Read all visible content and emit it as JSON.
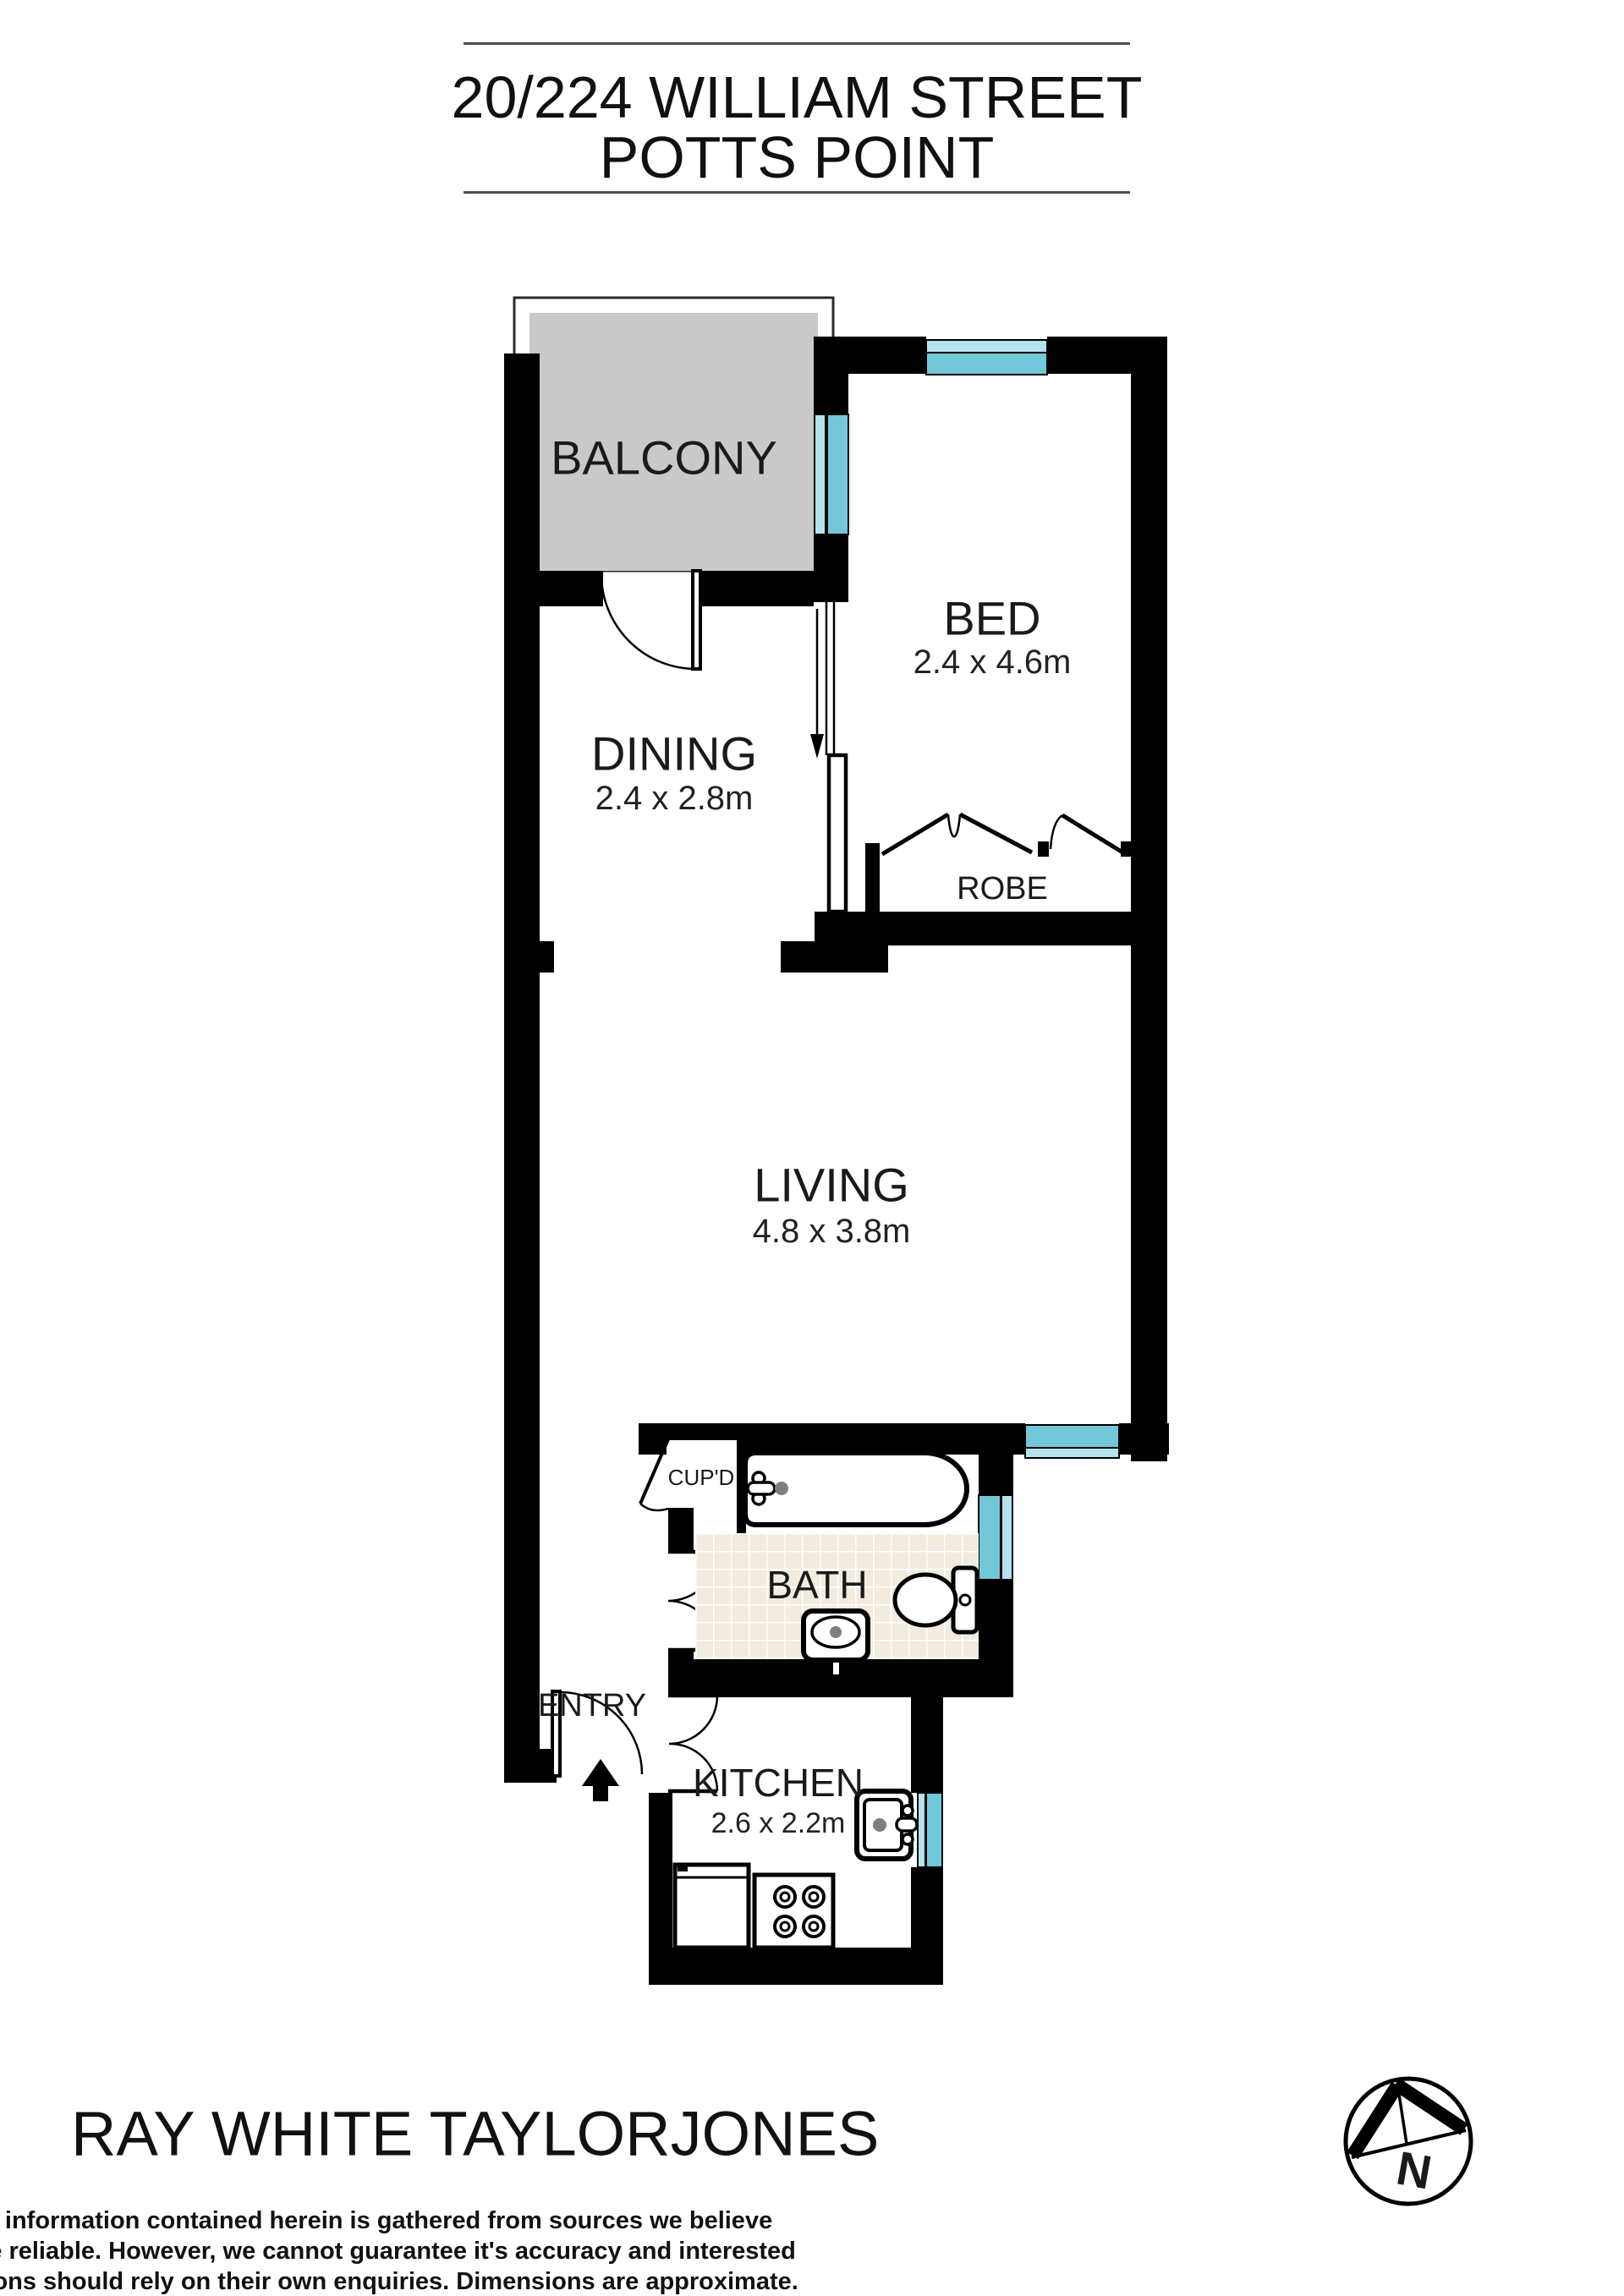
{
  "title": {
    "line1": "20/224 WILLIAM STREET",
    "line2": "POTTS POINT"
  },
  "rooms": {
    "balcony": {
      "label": "BALCONY"
    },
    "bed": {
      "label": "BED",
      "dimensions": "2.4 x 4.6m"
    },
    "dining": {
      "label": "DINING",
      "dimensions": "2.4 x 2.8m"
    },
    "robe": {
      "label": "ROBE"
    },
    "living": {
      "label": "LIVING",
      "dimensions": "4.8 x 3.8m"
    },
    "bath": {
      "label": "BATH"
    },
    "cupboard": {
      "label": "CUP'D"
    },
    "entry": {
      "label": "ENTRY"
    },
    "kitchen": {
      "label": "KITCHEN",
      "dimensions": "2.6 x 2.2m"
    }
  },
  "compass": {
    "north_label": "N"
  },
  "footer": {
    "agency": "RAY WHITE TAYLORJONES",
    "disclaimer_lines": [
      "All information contained herein is gathered from sources we believe",
      "to be reliable. However, we cannot guarantee it's accuracy and interested",
      "persons should rely on their own enquiries. Dimensions are approximate."
    ]
  },
  "colors": {
    "wall": "#000000",
    "balcony_floor": "#c9c9c9",
    "window_glass": "#72c7d8",
    "window_glass_light": "#b5e2ec",
    "tile": "#f2ebdf",
    "fixture_dot": "#7f7f7f",
    "text": "#1a1a1a"
  }
}
